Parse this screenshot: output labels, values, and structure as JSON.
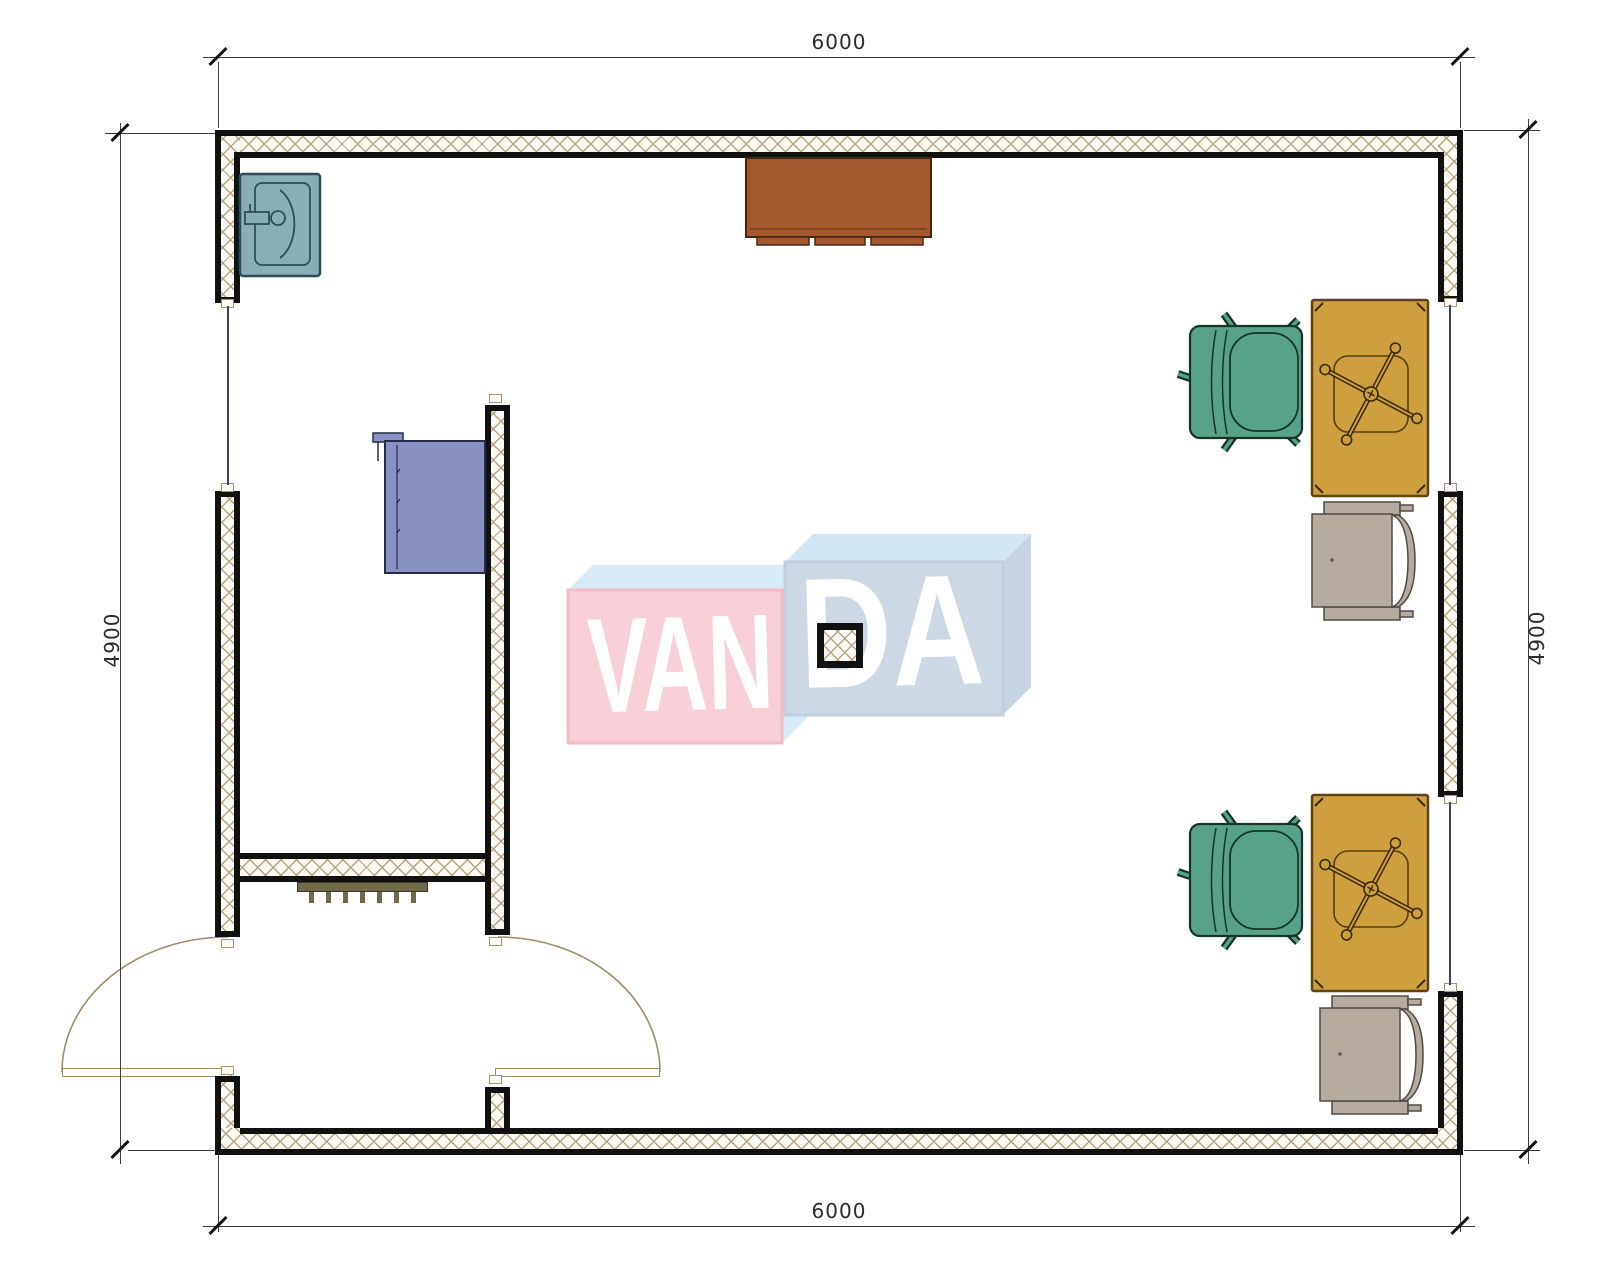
{
  "meta": {
    "type": "architectural-floor-plan"
  },
  "dimensions": {
    "top": "6000",
    "bottom": "6000",
    "left": "4900",
    "right": "4900"
  },
  "watermark": {
    "text_left": "VAN",
    "text_right": "DA",
    "full_text": "VANDA",
    "left_face_color": "#f8cfd6",
    "right_face_color": "#cdd8e5",
    "bevel_color": "#d7eaf6",
    "text_color": "#ffffff"
  },
  "palette": {
    "wall_border": "#111111",
    "hatch_line": "#b8a583",
    "window_glass": "#3a3f6e",
    "door": "#a08c68",
    "sink": "#8badb5",
    "counter": "#a4592c",
    "wardrobe": "#8a92c3",
    "desk": "#cf9e3f",
    "office_chair": "#57a389",
    "side_chair": "#b5ab9f",
    "radiator": "#6f6a4a",
    "dimension_line": "#141414"
  },
  "contents": {
    "rooms": [
      "main-room",
      "vestibule"
    ],
    "windows": 3,
    "doors": 2,
    "furniture": [
      "sink",
      "counter",
      "wardrobe",
      "desk",
      "desk",
      "office-chair",
      "office-chair",
      "side-chair",
      "side-chair",
      "radiator",
      "column"
    ]
  }
}
